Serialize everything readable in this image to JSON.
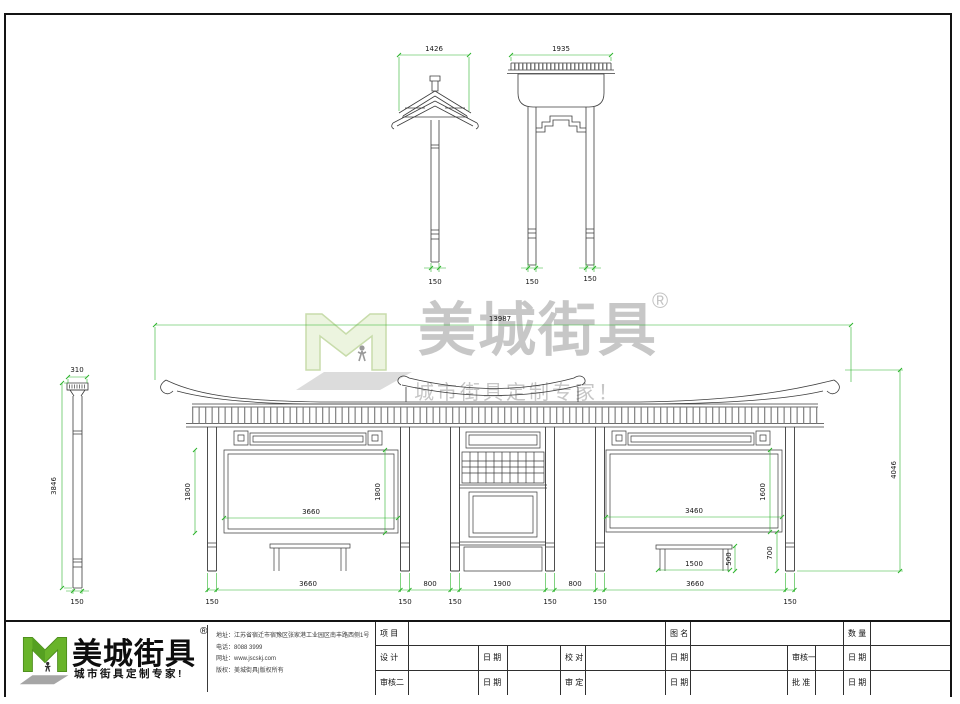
{
  "watermark": {
    "brand": "美城街具",
    "reg": "®",
    "slogan": "城市街具定制专家！"
  },
  "footer_logo": {
    "brand": "美城街具",
    "reg": "®",
    "slogan": "城市街具定制专家!",
    "contact": [
      {
        "label": "地址：",
        "value": "江苏省宿迁市宿豫区张家港工业园区南丰路西侧1号"
      },
      {
        "label": "电话：",
        "value": "8088 3999"
      },
      {
        "label": "网址：",
        "value": "www.jscskj.com"
      },
      {
        "label": "版权：",
        "value": "美城街具|版权所有"
      }
    ]
  },
  "title_block": {
    "row1": [
      "项 目",
      "图 名",
      "数 量"
    ],
    "row2": [
      "设 计",
      "日 期",
      "校 对",
      "日 期",
      "审核一",
      "日 期"
    ],
    "row3": [
      "审核二",
      "日 期",
      "审 定",
      "日 期",
      "批 准",
      "日 期"
    ]
  },
  "dims": {
    "gate_side_width": "1426",
    "gate_side_base": "150",
    "gate_front_width": "1935",
    "gate_front_leg_left": "150",
    "gate_front_leg_right": "150",
    "column_cap_width": "310",
    "column_height": "3846",
    "column_base": "150",
    "total_width": "13987",
    "total_height": "4046",
    "left_panel_height_left": "1800",
    "left_panel_height_right": "1800",
    "left_panel_width": "3660",
    "right_panel_width": "3460",
    "right_panel_height": "1600",
    "right_bench_width": "1500",
    "right_bench_height": "500",
    "right_clearance": "700",
    "bay_left_width": "3660",
    "gap_left": "800",
    "bay_center_width": "1900",
    "gap_right": "800",
    "bay_right_width": "3660",
    "post_widths": [
      "150",
      "150",
      "150",
      "150",
      "150",
      "150"
    ]
  },
  "colors": {
    "dimension_green": "#2cb42c",
    "line_ink": "#3c3c3c",
    "logo_green": "#69b42a",
    "watermark_gray": "#c7c7c7"
  }
}
